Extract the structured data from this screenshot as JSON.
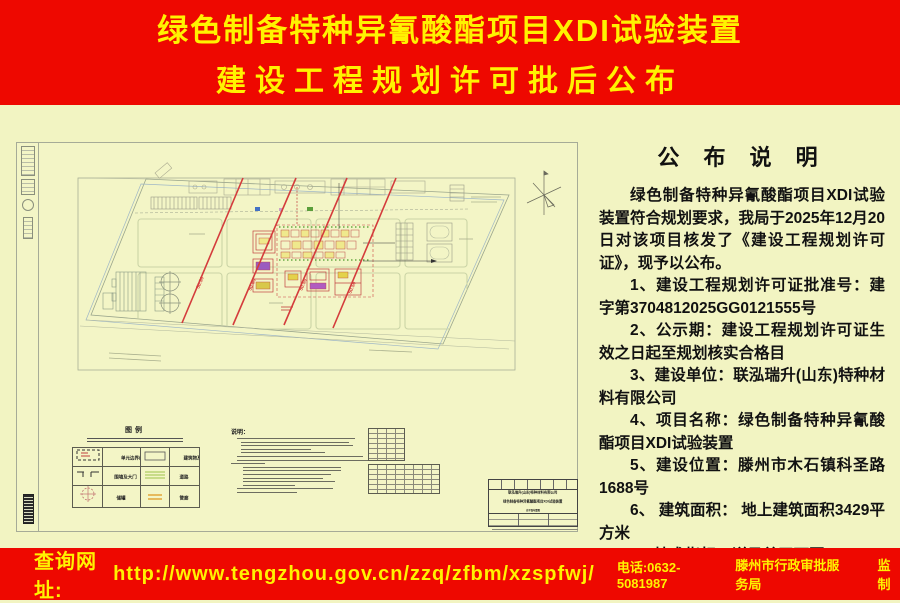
{
  "colors": {
    "banner_red": "#ee0800",
    "banner_yellow": "#fff200",
    "background_cream": "#f2f4c2",
    "redline": "#d43c3c"
  },
  "header": {
    "line1": "绿色制备特种异氰酸酯项目XDI试验装置",
    "line2": "建设工程规划许可批后公布"
  },
  "announcement": {
    "title": "公 布 说 明",
    "intro": "绿色制备特种异氰酸酯项目XDI试验装置符合规划要求，我局于2025年12月20日对该项目核发了《建设工程规划许可证》，现予以公布。",
    "items": [
      "1、建设工程规划许可证批准号：建字第3704812025GG0121555号",
      "2、公示期：建设工程规划许可证生效之日起至规划核实合格目",
      "3、建设单位：联泓瑞升(山东)特种材料有限公司",
      "4、项目名称：绿色制备特种异氰酸酯项目XDI试验装置",
      "5、建设位置：滕州市木石镇科圣路1688号",
      "6、 建筑面积： 地上建筑面积3429平方米",
      "7、技术指标：详见总平面图"
    ]
  },
  "drawing": {
    "legend": {
      "title": "图例",
      "items": [
        {
          "symbol": "dashed-boundary",
          "label": "单元边界线及名称"
        },
        {
          "symbol": "building-rect",
          "label": "建筑物及栋号"
        },
        {
          "symbol": "wall-gate",
          "label": "围墙及大门"
        },
        {
          "symbol": "road-lines",
          "label": "道路"
        },
        {
          "symbol": "tank-circle",
          "label": "储罐"
        },
        {
          "symbol": "pipe-rack",
          "label": "管廊"
        }
      ]
    },
    "notes_title": "说明：",
    "red_line_label": "50.50",
    "title_block": {
      "company": "联泓瑞升(山东)特种材料有限公司",
      "project": "绿色制备特种异氰酸酯项目XDI试验装置",
      "drawing_name": "总平面布置图"
    }
  },
  "footer": {
    "url_label": "查询网址:",
    "url": "http://www.tengzhou.gov.cn/zzq/zfbm/xzspfwj/",
    "phone": "电话:0632-5081987",
    "org": "滕州市行政审批服务局",
    "supervision": "监制"
  }
}
